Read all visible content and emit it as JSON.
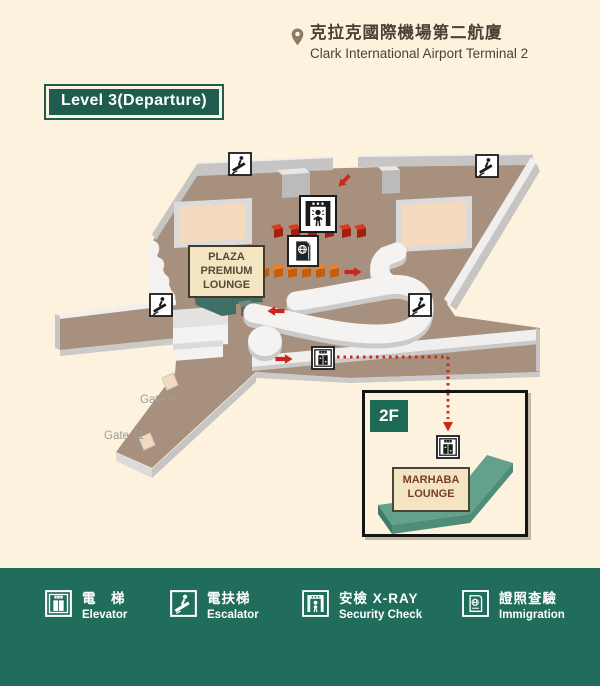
{
  "header": {
    "location_zh": "克拉克國際機場第二航廈",
    "location_en": "Clark International Airport Terminal 2"
  },
  "level_badge": {
    "label": "Level 3(Departure)"
  },
  "map": {
    "plaza_lounge": {
      "l1": "PLAZA",
      "l2": "PREMIUM",
      "l3": "LOUNGE"
    },
    "gates": {
      "gate9": "Gate 9",
      "gate11": "Gate 11"
    }
  },
  "inset": {
    "floor": "2F",
    "marhaba": {
      "l1": "MARHABA",
      "l2": "LOUNGE"
    }
  },
  "legend": {
    "items": [
      {
        "icon": "elevator-icon",
        "zh": "電　梯",
        "en": "Elevator"
      },
      {
        "icon": "escalator-icon",
        "zh": "電扶梯",
        "en": "Escalator"
      },
      {
        "icon": "security-check-icon",
        "zh": "安檢 X-RAY",
        "en": "Security Check"
      },
      {
        "icon": "immigration-icon",
        "zh": "證照查驗",
        "en": "Immigration"
      }
    ]
  },
  "colors": {
    "background": "#fdf2de",
    "floor": "#a8907e",
    "legend_green": "#216d5c",
    "badge_green": "#1d5c4e",
    "inset_badge_green": "#1d6a57",
    "red": "#c8281c",
    "orange": "#ee8127",
    "peach": "#f5d9bc",
    "teal_area": "#3e7065",
    "lounge_block_teal": "#64a18c",
    "label_cream": "#f3e5c2"
  }
}
